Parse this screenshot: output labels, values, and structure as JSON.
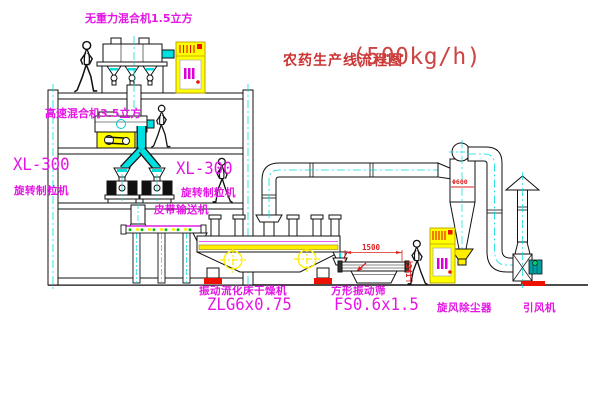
{
  "title": {
    "text": "农药生产线流程图",
    "capacity": "(500kg/h)"
  },
  "equipment": {
    "gravity_mixer": {
      "label": "无重力混合机1.5立方"
    },
    "high_speed_mixer": {
      "label": "高速混合机3.5立方"
    },
    "granulator_left": {
      "model": "XL-300",
      "name": "旋转制粒机"
    },
    "granulator_right": {
      "model": "XL-300",
      "name": "旋转制粒机"
    },
    "belt_conveyor": {
      "name": "皮带输送机"
    },
    "fluid_bed_dryer": {
      "name": "振动流化床干燥机",
      "model": "ZLG6x0.75"
    },
    "vibrating_screen": {
      "name": "方形振动筛",
      "model": "FS0.6x1.5"
    },
    "cyclone": {
      "name": "旋风除尘器"
    },
    "induced_draft_fan": {
      "name": "引风机"
    }
  },
  "dimensions": {
    "screen_length": "1500",
    "screen_height": "341",
    "cyclone_inlet": "Φ600"
  },
  "colors": {
    "label_magenta": "#e515e5",
    "title_red": "#cc3333",
    "dimension_red": "#dd2222",
    "pipe_cyan": "#00e0e0",
    "cabinet_yellow": "#ffff00",
    "base_red": "#ee1100",
    "motor_teal": "#00a0a0",
    "line_black": "#111111"
  }
}
